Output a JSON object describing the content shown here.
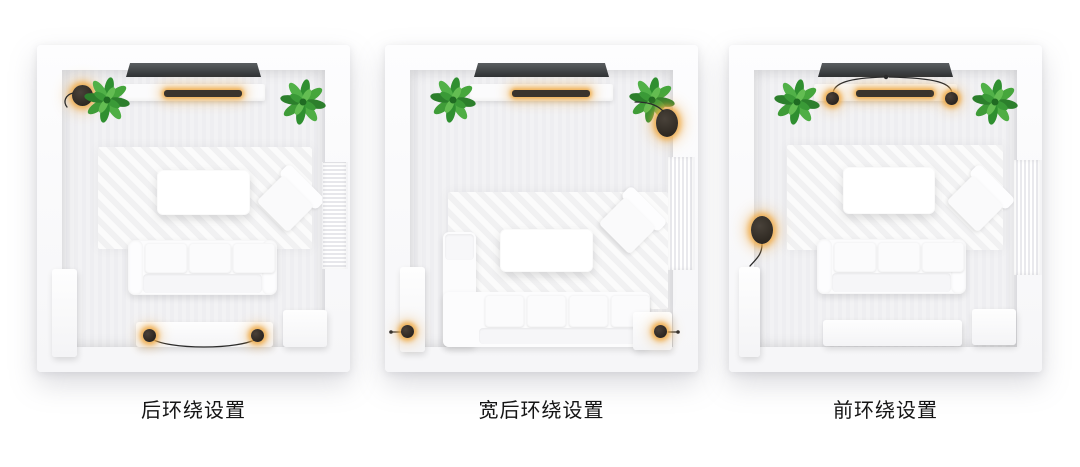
{
  "page": {
    "background": "#ffffff"
  },
  "colors": {
    "glow_accent": "#EEAA46",
    "tv_screen": "#3C4043",
    "soundbar_body": "#37302A",
    "speaker_body": "#26211B",
    "plant_green": "#3C9A3C",
    "wall_white": "#FCFCFD",
    "floor_gray": "#F0F0F2",
    "furniture_white": "#FBFBFC",
    "caption_text": "#141414"
  },
  "diagrams": [
    {
      "id": "rear-surround",
      "caption": "后环绕设置",
      "room_elements": [
        "tv",
        "media-console",
        "soundbar-glowing",
        "subwoofer-front-left-corner",
        "potted-plant-left",
        "potted-plant-right",
        "area-rug",
        "coffee-table",
        "accent-armchair",
        "three-seat-sofa",
        "wall-radiator",
        "tall-cabinet",
        "rear-speaker-bench",
        "rear-surround-speaker-left",
        "rear-surround-speaker-right",
        "connecting-cable",
        "side-table"
      ]
    },
    {
      "id": "wide-rear-surround",
      "caption": "宽后环绕设置",
      "room_elements": [
        "tv",
        "media-console",
        "soundbar-glowing",
        "potted-plant-left",
        "potted-plant-right",
        "subwoofer-front-right-corner",
        "area-rug",
        "coffee-table",
        "accent-armchair",
        "corner-sectional-sofa",
        "wall-curtain",
        "tall-cabinet",
        "wide-surround-speaker-left",
        "wide-surround-speaker-right",
        "speaker-cable-stubs",
        "side-table"
      ]
    },
    {
      "id": "front-surround",
      "caption": "前环绕设置",
      "room_elements": [
        "tv",
        "media-console",
        "soundbar-glowing",
        "front-surround-speaker-left",
        "front-surround-speaker-right",
        "speaker-cables-to-tv",
        "potted-plant-left",
        "potted-plant-right",
        "subwoofer-left-wall",
        "subwoofer-cable",
        "area-rug",
        "coffee-table",
        "accent-armchair",
        "three-seat-sofa",
        "wall-curtain",
        "tall-cabinet",
        "storage-bench",
        "side-table"
      ]
    }
  ]
}
